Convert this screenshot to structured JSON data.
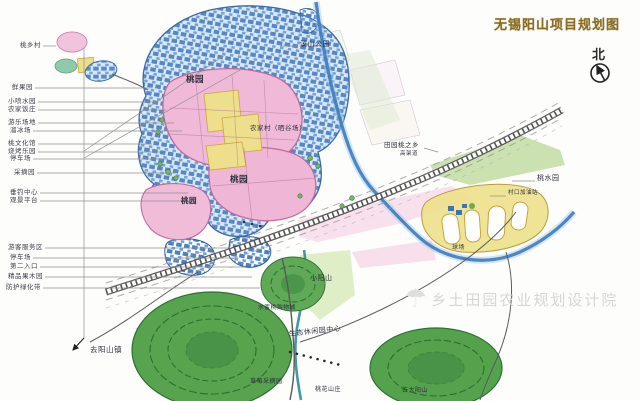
{
  "title": {
    "text": "无锡阳山项目规划图"
  },
  "compass": {
    "label": "北"
  },
  "watermark": {
    "text": "乡土田园农业规划设计院",
    "icon": "tree-umbrella-logo"
  },
  "palette": {
    "title_color": "#8a6d1f",
    "village_blue": "#4a82c2",
    "orchard_pink": "#f0b9d7",
    "field_yellow": "#eedf8c",
    "hill_green": "#57a34e",
    "river_blue": "#3c7cbc",
    "stream_teal": "#2f8e96",
    "watermark_gray": "#d6d6d6"
  },
  "legend_left": [
    {
      "text": "桃乡村",
      "x": 20,
      "y": 46,
      "to": 56
    },
    {
      "text": "鲜果园",
      "x": 12,
      "y": 88,
      "to": 150
    },
    {
      "text": "小喷水园",
      "x": 8,
      "y": 102,
      "to": 158
    },
    {
      "text": "农家饭庄",
      "x": 8,
      "y": 110,
      "to": 166
    },
    {
      "text": "游乐场地",
      "x": 8,
      "y": 123,
      "to": 174
    },
    {
      "text": "溜冰场",
      "x": 10,
      "y": 131,
      "to": 182
    },
    {
      "text": "桃文化馆",
      "x": 8,
      "y": 144,
      "to": 152
    },
    {
      "text": "烧烤乐园",
      "x": 8,
      "y": 152,
      "to": 160
    },
    {
      "text": "停车场",
      "x": 10,
      "y": 159,
      "to": 168
    },
    {
      "text": "采摘园",
      "x": 14,
      "y": 173,
      "to": 176
    },
    {
      "text": "垂钓中心",
      "x": 10,
      "y": 193,
      "to": 188
    },
    {
      "text": "观景平台",
      "x": 10,
      "y": 201,
      "to": 196
    },
    {
      "text": "游客服务区",
      "x": 8,
      "y": 248,
      "to": 228
    },
    {
      "text": "停车场",
      "x": 10,
      "y": 258,
      "to": 236
    },
    {
      "text": "第二入口",
      "x": 10,
      "y": 267,
      "to": 244
    },
    {
      "text": "精品果木园",
      "x": 8,
      "y": 277,
      "to": 252
    },
    {
      "text": "防护绿化带",
      "x": 6,
      "y": 288,
      "to": 260
    }
  ],
  "map_labels": [
    {
      "text": "溪山公园",
      "x": 300,
      "y": 46,
      "s": 7
    },
    {
      "text": "桃园",
      "x": 186,
      "y": 82,
      "s": 8.5,
      "b": 1
    },
    {
      "text": "农家村（晒谷场）",
      "x": 250,
      "y": 130,
      "s": 6.5
    },
    {
      "text": "田园桃之乡",
      "x": 384,
      "y": 147,
      "s": 6.5
    },
    {
      "text": "高架道",
      "x": 400,
      "y": 156,
      "s": 5.5
    },
    {
      "text": "桃水园",
      "x": 537,
      "y": 180,
      "s": 7
    },
    {
      "text": "村口加油站",
      "x": 508,
      "y": 195,
      "s": 5.5
    },
    {
      "text": "桃园",
      "x": 230,
      "y": 182,
      "s": 8.5,
      "b": 1
    },
    {
      "text": "桃园",
      "x": 181,
      "y": 203,
      "s": 7.5,
      "b": 1
    },
    {
      "text": "球场",
      "x": 452,
      "y": 249,
      "s": 6
    },
    {
      "text": "小阳山",
      "x": 310,
      "y": 280,
      "s": 7
    },
    {
      "text": "水蜜桃购物城",
      "x": 258,
      "y": 310,
      "s": 5.8
    },
    {
      "text": "生态休闲园中心",
      "x": 289,
      "y": 336,
      "s": 7,
      "r": -6
    },
    {
      "text": "草莓采摘园",
      "x": 250,
      "y": 383,
      "s": 6
    },
    {
      "text": "桃花山庄",
      "x": 315,
      "y": 391,
      "s": 6
    },
    {
      "text": "去大阳山",
      "x": 402,
      "y": 392,
      "s": 6
    },
    {
      "text": "去阳山镇",
      "x": 90,
      "y": 352,
      "s": 7.5
    }
  ]
}
